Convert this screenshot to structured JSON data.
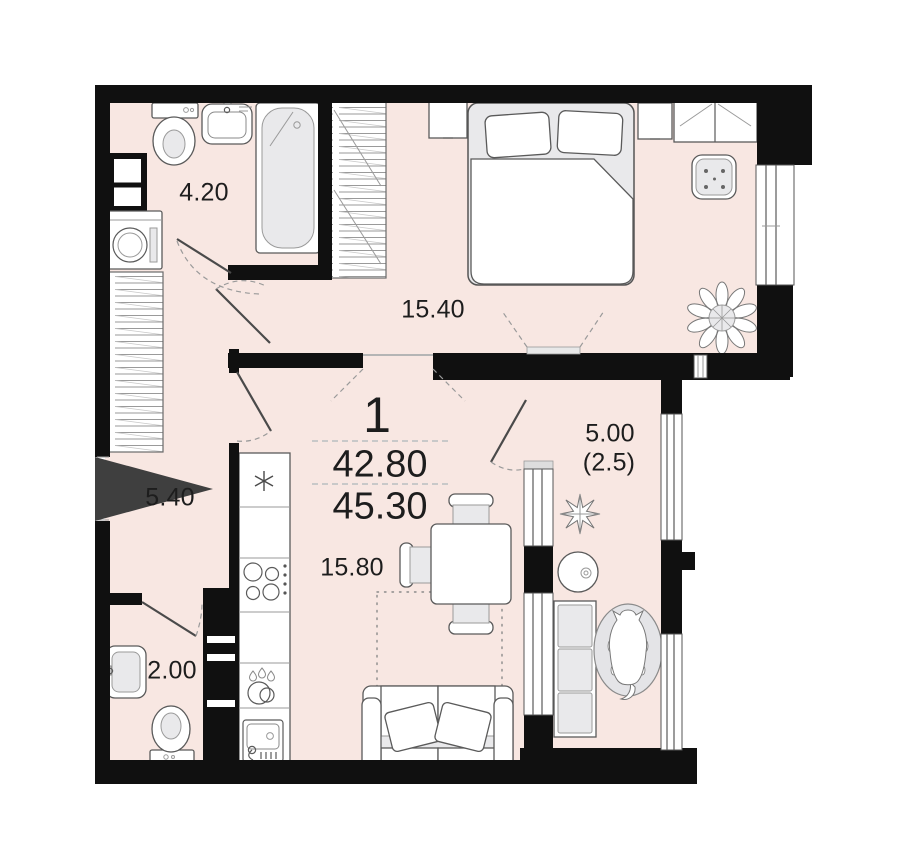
{
  "plan_summary": {
    "rooms_count_label": "1",
    "living_area": "42.80",
    "total_area": "45.30"
  },
  "rooms": [
    {
      "id": "bathroom",
      "area_label": "4.20"
    },
    {
      "id": "bedroom",
      "area_label": "15.40"
    },
    {
      "id": "hallway",
      "area_label": "5.40"
    },
    {
      "id": "wc",
      "area_label": "2.00"
    },
    {
      "id": "kitchen-living",
      "area_label": "15.80"
    },
    {
      "id": "balcony",
      "area_label": "5.00",
      "area_label_secondary": "(2.5)"
    }
  ],
  "colors": {
    "floor": "#f8e7e2",
    "walls": "#101010",
    "furniture_fill": "#ffffff",
    "furniture_gray": "#e9e9eb",
    "entrance_arrow": "#3f3f3f",
    "dashed_guides": "#9a9a9a"
  },
  "icons": [
    "entrance-arrow-icon",
    "bathtub-icon",
    "toilet-icon",
    "washbasin-icon",
    "washing-machine-icon",
    "duct-shaft-icon",
    "wardrobe-hangers-icon",
    "double-bed-icon",
    "nightstand-icon",
    "wardrobe-icon",
    "pouf-icon",
    "potted-plant-icon",
    "fridge-icon",
    "stove-icon",
    "dishwasher-icon",
    "kitchen-sink-icon",
    "dining-table-icon",
    "chair-icon",
    "sofa-icon",
    "rug-icon",
    "balcony-bench-icon",
    "round-table-icon",
    "dog-on-rug-icon",
    "window-icon",
    "door-swing-icon"
  ]
}
